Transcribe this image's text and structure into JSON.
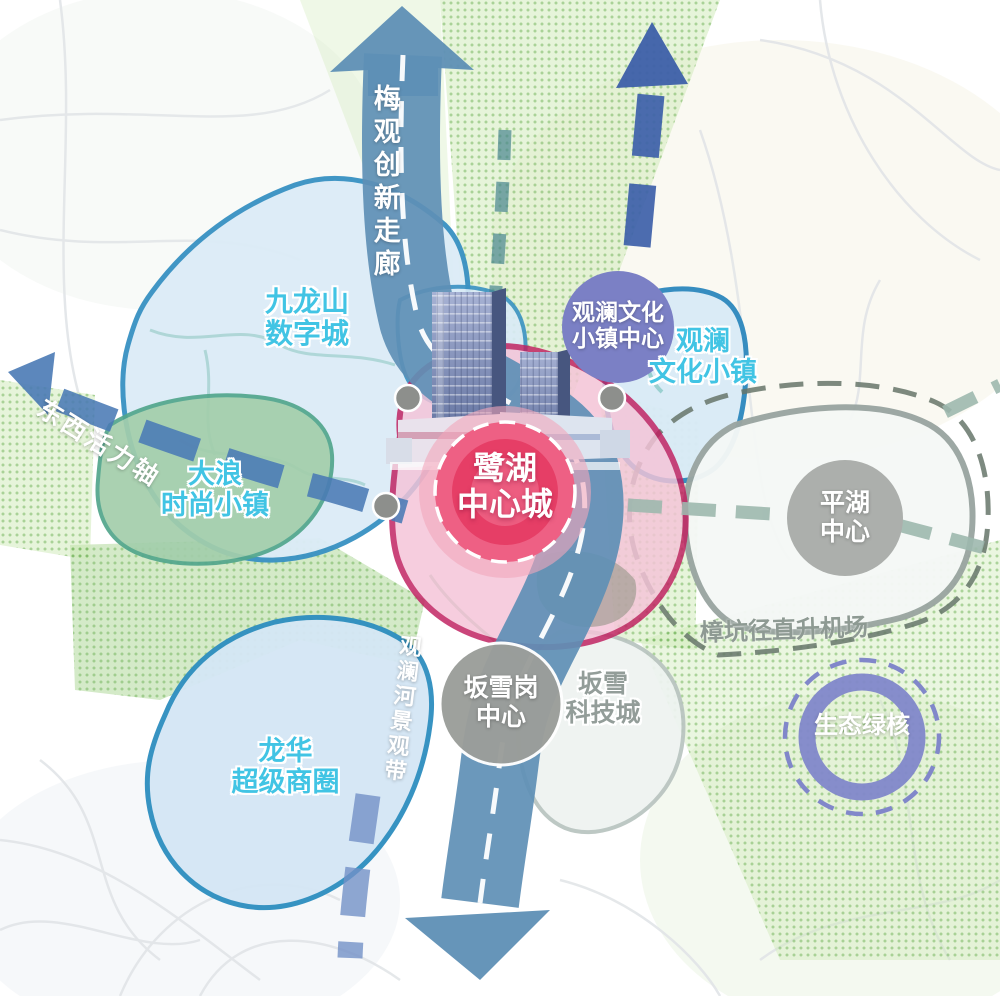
{
  "corridors": {
    "meiguan": "梅观创新走廊",
    "east_west_axis": "东西活力轴",
    "guanlan_river_belt": "观澜河景观带"
  },
  "zones": {
    "jiulongshan": {
      "line1": "九龙山",
      "line2": "数字城"
    },
    "dalang": {
      "line1": "大浪",
      "line2": "时尚小镇"
    },
    "longhua": {
      "line1": "龙华",
      "line2": "超级商圈"
    },
    "guanlan_town": {
      "line1": "观澜",
      "line2": "文化小镇"
    },
    "banxue_tech": {
      "line1": "坂雪",
      "line2": "科技城"
    }
  },
  "nodes": {
    "luhu_central": {
      "line1": "鹭湖",
      "line2": "中心城"
    },
    "guanlan_town_center": {
      "line1": "观澜文化",
      "line2": "小镇中心"
    },
    "pinghu_center": {
      "line1": "平湖",
      "line2": "中心"
    },
    "banxuegang_center": {
      "line1": "坂雪岗",
      "line2": "中心"
    },
    "ecological_green_core": "生态绿核"
  },
  "annotations": {
    "heliport": "樟坑径直升机场"
  },
  "colors": {
    "corridor_blue": "#5E8FB5",
    "navy_dash": "#3D5FA9",
    "axis_blue": "#4A7AB5",
    "zone_border_blue": "#3492C4",
    "zone_fill_blue": "#D9EAF6",
    "green_zone_fill": "#A3CEAB",
    "green_zone_border": "#52A68C",
    "pink_zone_fill": "#F5C4D8",
    "pink_zone_border": "#C02060",
    "bullseye_red": "#E63E66",
    "node_gray": "#8D8F8C",
    "circle_gray": "#A4A7A4",
    "badge_purple": "#7B80C5",
    "ring_purple": "#8187CA",
    "teal_dash": "#9DB8AE",
    "boundary_dash_gray": "#66756A",
    "label_cyan": "#41C4E4",
    "label_gray": "#8E9A93"
  }
}
